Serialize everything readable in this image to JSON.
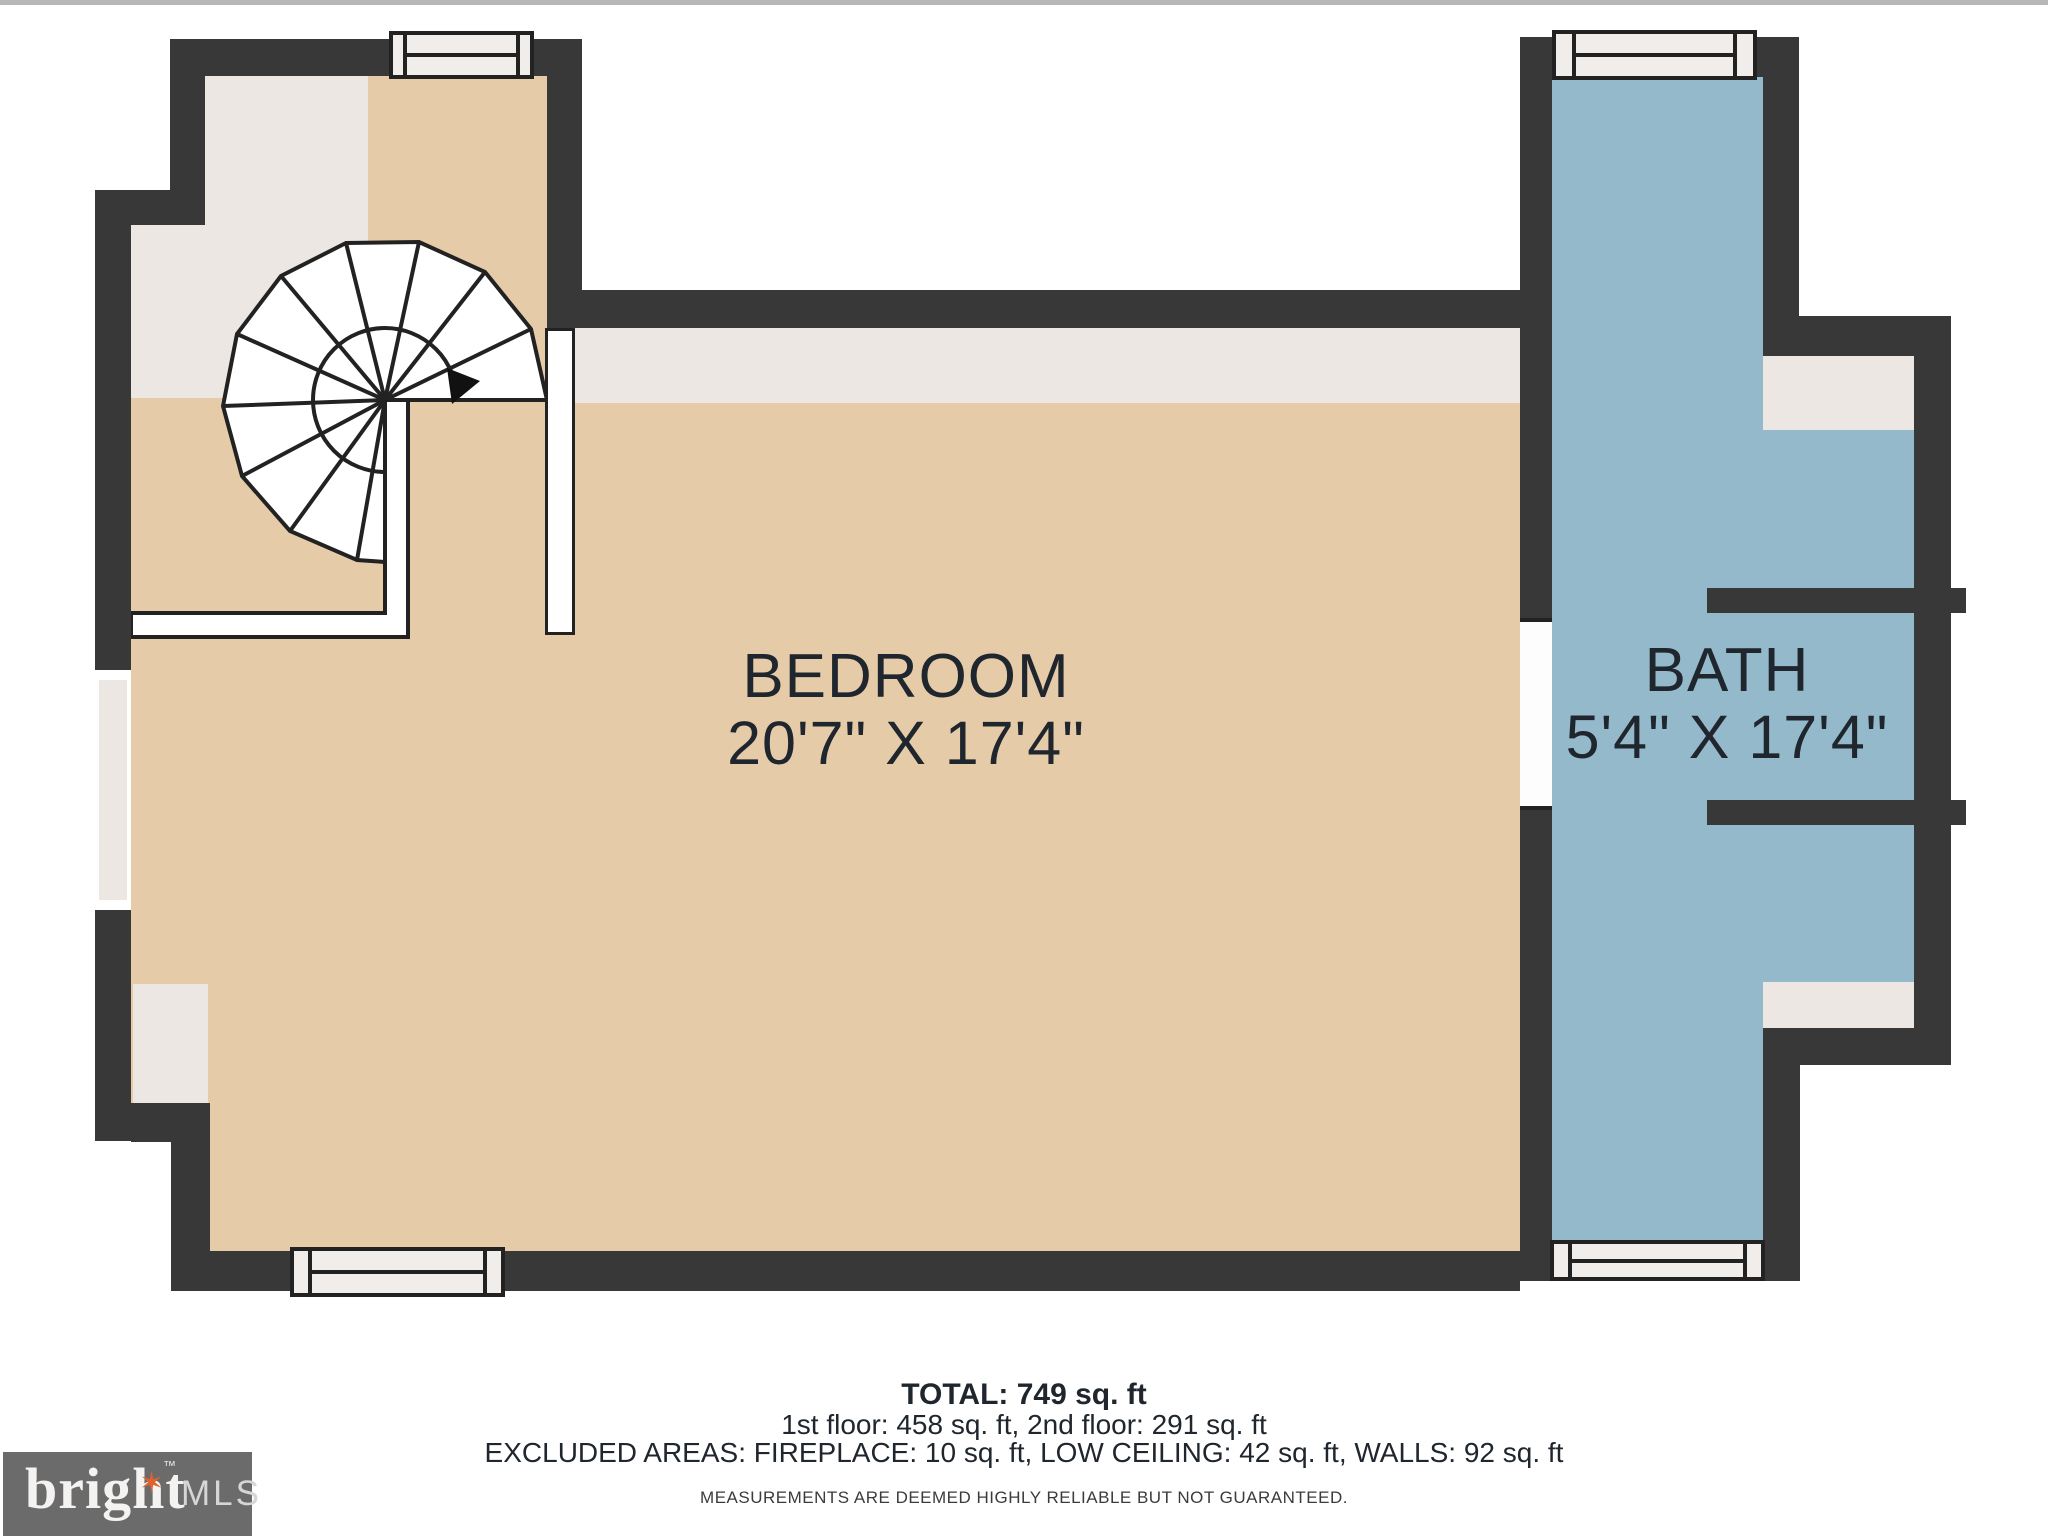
{
  "plan": {
    "type": "floor-plan",
    "rooms": {
      "bedroom": {
        "name": "BEDROOM",
        "dims": "20'7\" X 17'4\""
      },
      "bath": {
        "name": "BATH",
        "dims": "5'4\" X 17'4\""
      }
    },
    "features": [
      "spiral-staircase",
      "windows",
      "doorway-opening"
    ]
  },
  "footer": {
    "total": "TOTAL: 749 sq. ft",
    "floors": "1st floor: 458 sq. ft, 2nd floor: 291 sq. ft",
    "excluded": "EXCLUDED AREAS: FIREPLACE: 10 sq. ft, LOW CEILING: 42 sq. ft, WALLS: 92 sq. ft",
    "disclaimer": "MEASUREMENTS ARE DEEMED HIGHLY RELIABLE BUT NOT GUARANTEED."
  },
  "logo": {
    "brand": "bright",
    "suffix": "MLS",
    "tm": "™",
    "star": "✶"
  },
  "colors": {
    "wall": "#383838",
    "line": "#222222",
    "tan": "#e5cba8",
    "gray": "#ece7e2",
    "blue": "#94b9cb",
    "winfill": "#f1edea",
    "text": "#20262e",
    "topline": "#b7b7b7",
    "logoBg": "#6b6b6b",
    "logoStar": "#e0622f"
  }
}
